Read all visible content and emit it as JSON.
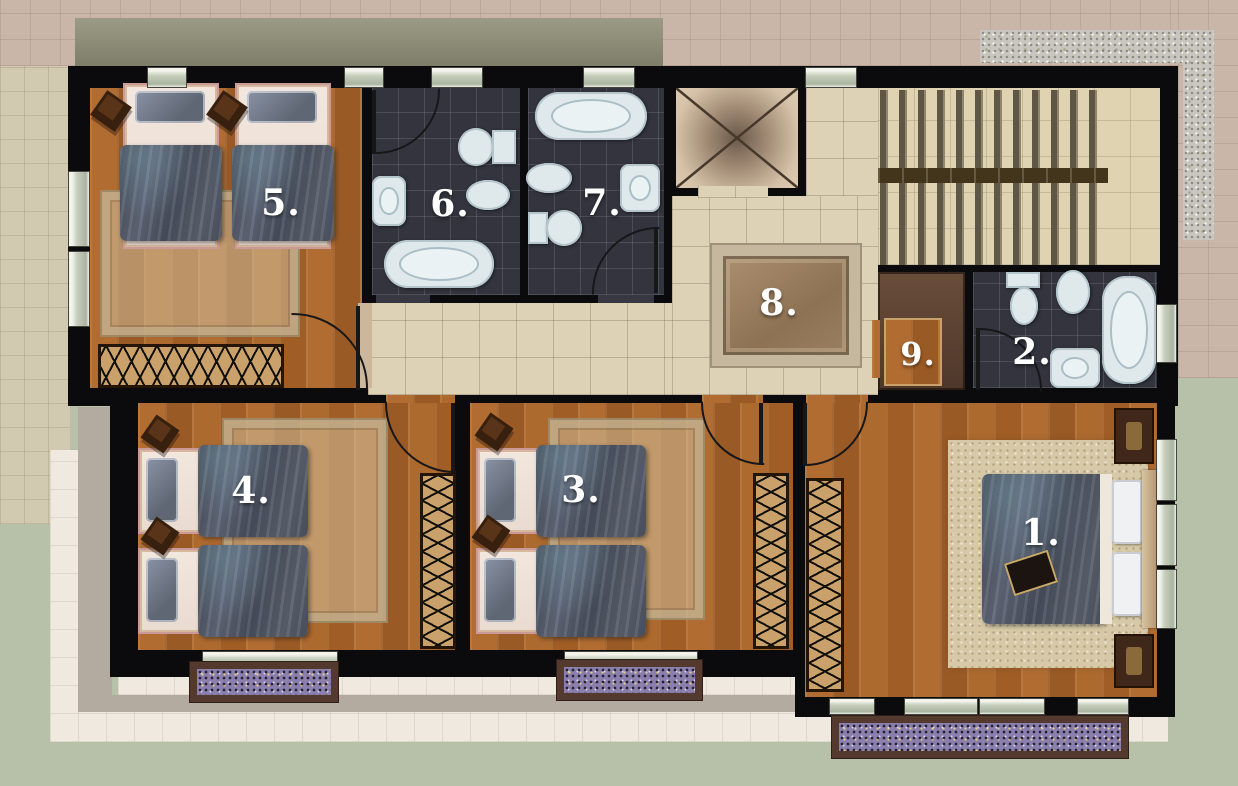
{
  "plan": {
    "labels": {
      "room1": "1.",
      "room2": "2.",
      "room3": "3.",
      "room4": "4.",
      "room5": "5.",
      "room6": "6.",
      "room7": "7.",
      "room8": "8.",
      "room9": "9."
    },
    "colors": {
      "wall": "#0b0b0d",
      "wood_floor": "#a9632b",
      "bathroom_tile": "#34343f",
      "hallway_tile": "#ddd2b6",
      "stairs": "#e0d3b2",
      "bedroom_rug": "#d1bf9c",
      "flower_box": "#8b7fae",
      "grass": "#b7c1aa",
      "walkway": "#efe9e0",
      "brick_paving": "#c9b6a9",
      "gravel_path": "#c9c6c0",
      "fixture": "#dfe9ec",
      "blanket": "#474b55",
      "radiator": "#caa06b",
      "label_text": "#ffffff"
    }
  }
}
